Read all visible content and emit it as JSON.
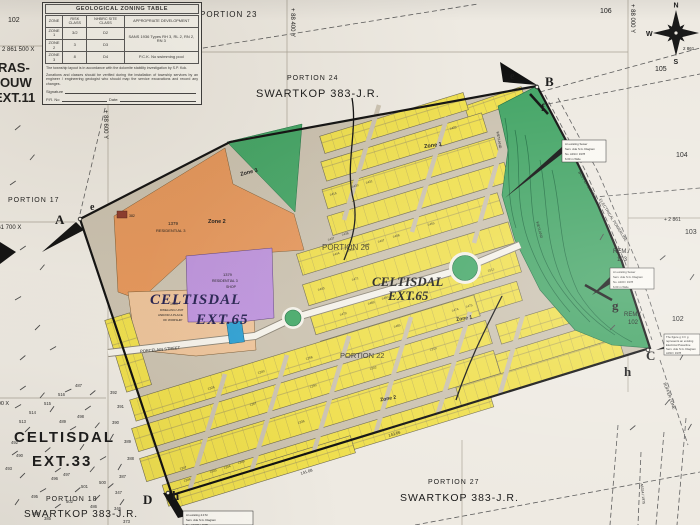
{
  "table": {
    "title": "GEOLOGICAL ZONING TABLE",
    "col_zone": "ZONE",
    "col_risk": "RISK CLASS",
    "col_site": "NHBRC SITE CLASS",
    "col_dev": "APPROPRIATE DEVELOPMENT",
    "rows": [
      {
        "zone": "ZONE 1",
        "risk": "3/2",
        "site": "D2"
      },
      {
        "zone": "ZONE 2",
        "risk": "3",
        "site": "D3"
      },
      {
        "zone": "ZONE 3",
        "risk": "8",
        "site": "D4"
      }
    ],
    "dev_12": "SANS 1936 Types RH 3, RL 2, RN 2, RN 3",
    "dev_3": "P.C.K. No swimming pool",
    "note1": "The township layout is in accordance with the dolomite stability investigation by S.P. Kok.",
    "note2": "Zonations and classes should be verified during the installation of township services by an engineer / engineering geologist who should map the service excavations and record any changes.",
    "signature": "Signature",
    "pr_no": "P.R. No",
    "date": "Date:"
  },
  "labels": {
    "portion17": "PORTION 17",
    "portion18": "PORTION 18",
    "portion22": "PORTION 22",
    "portion23": "PORTION 23",
    "portion24": "PORTION 24",
    "portion26": "PORTION 26",
    "portion27": "PORTION 27",
    "swartkop": "SWARTKOP 383-J.R.",
    "raslouw1": "RAS-",
    "raslouw2": "LOUW",
    "raslouw3": "EXT.11",
    "ext33_1": "CELTISDAL",
    "ext33_2": "EXT.33",
    "ext65_1": "CELTISDAL",
    "ext65_2": "EXT.65",
    "rem": "REM./",
    "n102": "102",
    "n103": "103",
    "n104": "104",
    "n105": "105",
    "n106": "106",
    "zone1": "Zone 1",
    "zone2": "Zone 2",
    "zone3": "Zone 3",
    "porcelain": "PORCELAIN STREET",
    "wetland": "WETLAND",
    "powerline": "ELECTRICAL POWERLINE",
    "buffer": "BUFFER ZONE",
    "res1379": "1379",
    "res3": "RESIDENTIAL 3",
    "shop": "SHOP",
    "e1380_1": "1380",
    "e1380_2": "DWELLING UNIT",
    "e1380_3": "AND/OR A PLACE",
    "e1380_4": "OF WORSHIP",
    "erf382": "382",
    "dim1": "141.08",
    "dim2": "143.66",
    "serv_vert": "A6334 / 1975"
  },
  "coords": {
    "x2861500": "2 861 500 X",
    "x861700": "861 700 X",
    "x861900": "861 900 X",
    "x2861": "+ 2 861",
    "y88400": "+ 88 400 Y",
    "y88000": "+ 88 000 Y",
    "y88600": "+ 88 600 Y",
    "c2861": "2 861"
  },
  "markers": {
    "A": "A",
    "B": "B",
    "C": "C",
    "D": "D",
    "e": "e",
    "f": "f",
    "g": "g",
    "h": "h"
  },
  "compass": {
    "n": "N",
    "e": "E",
    "s": "S",
    "w": "W"
  },
  "note_boxes": {
    "b1": [
      "An existing Sewer",
      "Serv. vide S.G. Diagram",
      "No. A194 / 1978",
      "6.00 m Wide"
    ],
    "b2": [
      "An existing Sewer",
      "Serv. vide S.G. Diagram",
      "No. A160 / 1978",
      "6.00 m Wide"
    ],
    "b3": [
      "The figure g C h g",
      "represents an existing",
      "Electrical Powerline",
      "Serv. vide S.G. Diagram",
      "A333 / 1978"
    ],
    "b4": [
      "An existing 4.0 M",
      "Serv. vide S.G. Diagram",
      "No. A107X / 1975"
    ]
  },
  "erven": [
    {
      "n": "1416",
      "x": 330,
      "y": 196
    },
    {
      "n": "1430",
      "x": 352,
      "y": 188
    },
    {
      "n": "1431",
      "x": 366,
      "y": 184
    },
    {
      "n": "1425",
      "x": 450,
      "y": 130
    },
    {
      "n": "1437",
      "x": 328,
      "y": 241
    },
    {
      "n": "1438",
      "x": 342,
      "y": 236
    },
    {
      "n": "1443",
      "x": 318,
      "y": 291
    },
    {
      "n": "1444",
      "x": 333,
      "y": 256
    },
    {
      "n": "1445",
      "x": 348,
      "y": 252
    },
    {
      "n": "1446",
      "x": 363,
      "y": 247
    },
    {
      "n": "1447",
      "x": 378,
      "y": 243
    },
    {
      "n": "1448",
      "x": 393,
      "y": 238
    },
    {
      "n": "1455",
      "x": 428,
      "y": 226
    },
    {
      "n": "1471",
      "x": 352,
      "y": 281
    },
    {
      "n": "1489",
      "x": 368,
      "y": 305
    },
    {
      "n": "1490",
      "x": 382,
      "y": 300
    },
    {
      "n": "1479",
      "x": 340,
      "y": 316
    },
    {
      "n": "1485",
      "x": 394,
      "y": 328
    },
    {
      "n": "1474",
      "x": 452,
      "y": 312
    },
    {
      "n": "1475",
      "x": 466,
      "y": 308
    },
    {
      "n": "1511",
      "x": 488,
      "y": 272
    },
    {
      "n": "1336",
      "x": 298,
      "y": 424
    },
    {
      "n": "1343",
      "x": 210,
      "y": 473
    },
    {
      "n": "1344",
      "x": 224,
      "y": 469
    },
    {
      "n": "1345",
      "x": 238,
      "y": 464
    },
    {
      "n": "1346",
      "x": 184,
      "y": 482
    },
    {
      "n": "1347",
      "x": 180,
      "y": 470
    },
    {
      "n": "1226",
      "x": 208,
      "y": 390
    },
    {
      "n": "1240",
      "x": 258,
      "y": 374
    },
    {
      "n": "1258",
      "x": 306,
      "y": 360
    },
    {
      "n": "1267",
      "x": 250,
      "y": 406
    },
    {
      "n": "1290",
      "x": 310,
      "y": 388
    },
    {
      "n": "1302",
      "x": 370,
      "y": 370
    },
    {
      "n": "1319",
      "x": 430,
      "y": 351
    }
  ],
  "ext33_erven": [
    {
      "n": "487",
      "x": 75,
      "y": 387
    },
    {
      "n": "516",
      "x": 58,
      "y": 396
    },
    {
      "n": "515",
      "x": 44,
      "y": 405
    },
    {
      "n": "514",
      "x": 29,
      "y": 414
    },
    {
      "n": "498",
      "x": 77,
      "y": 418
    },
    {
      "n": "489",
      "x": 59,
      "y": 423
    },
    {
      "n": "513",
      "x": 19,
      "y": 423
    },
    {
      "n": "492",
      "x": 11,
      "y": 444
    },
    {
      "n": "493",
      "x": 5,
      "y": 470
    },
    {
      "n": "496",
      "x": 51,
      "y": 480
    },
    {
      "n": "497",
      "x": 63,
      "y": 476
    },
    {
      "n": "500",
      "x": 99,
      "y": 484
    },
    {
      "n": "501",
      "x": 81,
      "y": 488
    },
    {
      "n": "495",
      "x": 31,
      "y": 498
    },
    {
      "n": "502",
      "x": 66,
      "y": 503
    },
    {
      "n": "503",
      "x": 32,
      "y": 515
    },
    {
      "n": "490",
      "x": 16,
      "y": 457
    },
    {
      "n": "392",
      "x": 110,
      "y": 394
    },
    {
      "n": "391",
      "x": 117,
      "y": 408
    },
    {
      "n": "390",
      "x": 112,
      "y": 424
    },
    {
      "n": "389",
      "x": 124,
      "y": 443
    },
    {
      "n": "388",
      "x": 127,
      "y": 460
    },
    {
      "n": "387",
      "x": 119,
      "y": 478
    },
    {
      "n": "347",
      "x": 115,
      "y": 494
    },
    {
      "n": "346",
      "x": 114,
      "y": 510
    },
    {
      "n": "373",
      "x": 123,
      "y": 523
    },
    {
      "n": "385",
      "x": 44,
      "y": 520
    },
    {
      "n": "486",
      "x": 90,
      "y": 508
    }
  ]
}
